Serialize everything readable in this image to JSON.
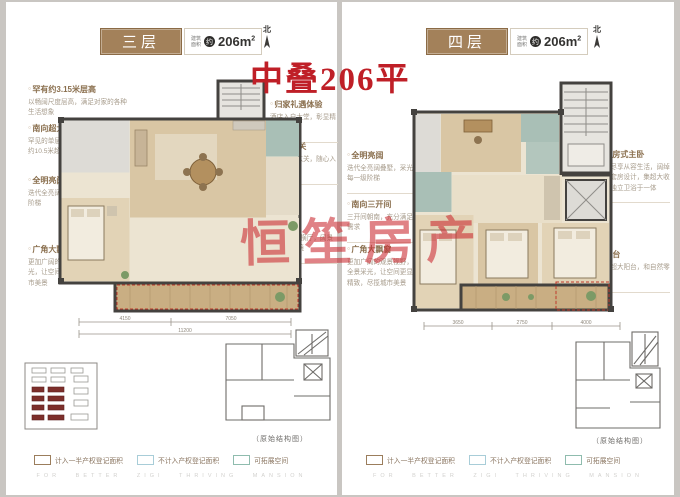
{
  "overlay": {
    "headline": "中叠206平",
    "watermark": "恒笙房产"
  },
  "shared": {
    "area_label_line1": "建筑",
    "area_label_line2": "面积",
    "area_circle": "约",
    "area_value": "206m",
    "area_sup": "2",
    "north_label": "北",
    "structure_caption": "（原始结构图）",
    "tagline": "FOR BETTER ZIGI THRIVING MANSION",
    "legend": [
      {
        "label": "计入一半产权登记面积",
        "color": "#9b7d5c"
      },
      {
        "label": "不计入产权登记面积",
        "color": "#a8cdd8"
      },
      {
        "label": "可拓展空间",
        "color": "#8fbcae"
      }
    ],
    "accent_red": "#bf1f27",
    "brown_header": "#a3815a"
  },
  "left_panel": {
    "floor": "三层",
    "annotations_left": [
      {
        "title": "罕有约3.15米层高",
        "body": "以畅阔尺度层高，满足对家的各种生活想象"
      },
      {
        "title": "南向超大开间",
        "body": "罕见的单层3开间的叠墅产品，单层约10.5米超大开间"
      },
      {
        "title": "全明亮阔",
        "body": "迭代全亮阔叠墅，采光直到每一级阶梯"
      },
      {
        "title": "广角大飘窗",
        "body": "更加广阔的观景视野，捕捉全园采光，让空间更显细腻精致，尽揽城市美景"
      }
    ],
    "annotations_right": [
      {
        "title": "归家礼遇体验",
        "body": "酒店入户大堂，彰显精致仪式感"
      },
      {
        "title": "独立玄关",
        "body": "独立入户玄关，随心入户体验"
      }
    ],
    "annotation_center": {
      "title": "阔绰横厅",
      "body": "约7.7米大尺度横厅，阔景采光，人文雅境"
    },
    "dims": {
      "seg1": "4150",
      "seg2": "7050",
      "total": "11200"
    }
  },
  "right_panel": {
    "floor": "四层",
    "annotations_left": [
      {
        "title": "全明亮阔",
        "body": "迭代全亮阔叠墅，采光直到每一级阶梯"
      },
      {
        "title": "南向三开间",
        "body": "三开间朝南，充分满足日照需求"
      },
      {
        "title": "广角大飘窗",
        "body": "更加广阔的观景视野，独享全景采光，让空间更显细腻精致，尽揽城市美景"
      }
    ],
    "annotations_right": [
      {
        "title": "全维套房式主卧",
        "body": "非凡境界尽享从容生活，阔绰主卧独立套房设计，集超大收纳空间、独立卫浴于一体"
      },
      {
        "title": "卧室阳台",
        "body": "卧室外接超大阳台，和自然零距离接触"
      }
    ],
    "dims": {
      "seg1": "3650",
      "seg2": "2750",
      "seg3": "4000"
    }
  }
}
